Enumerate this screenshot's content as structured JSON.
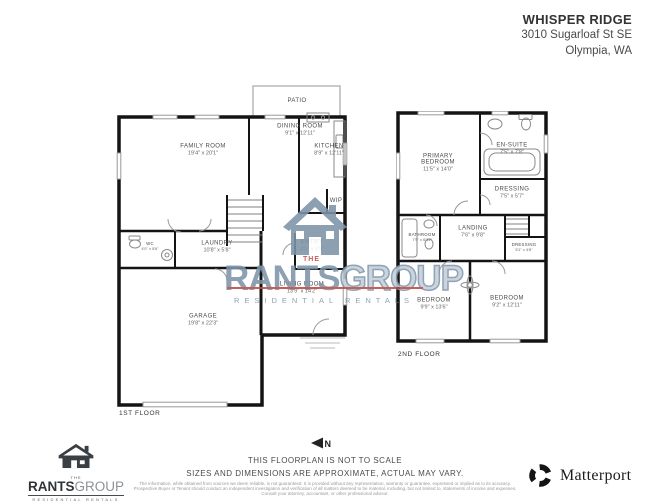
{
  "header": {
    "title": "WHISPER RIDGE",
    "address1": "3010 Sugarloaf St SE",
    "address2": "Olympia, WA"
  },
  "floor1": {
    "label": "1ST FLOOR",
    "rooms": {
      "patio": {
        "name": "PATIO",
        "dims": ""
      },
      "family": {
        "name": "FAMILY ROOM",
        "dims": "19'4\" x 20'1\""
      },
      "dining": {
        "name": "DINING ROOM",
        "dims": "9'1\" x 12'11\""
      },
      "kitchen": {
        "name": "KITCHEN",
        "dims": "8'9\" x 12'11\""
      },
      "wip": {
        "name": "WIP",
        "dims": ""
      },
      "entry": {
        "name": "ENTRY",
        "dims": "4'5\" x 9'9\""
      },
      "wc": {
        "name": "WC",
        "dims": "4'0\" x 5'6\""
      },
      "laundry": {
        "name": "LAUNDRY",
        "dims": "10'8\" x 5'8\""
      },
      "living": {
        "name": "LIVING ROOM",
        "dims": "13'9\" x 14'2\""
      },
      "garage": {
        "name": "GARAGE",
        "dims": "19'8\" x 22'3\""
      }
    }
  },
  "floor2": {
    "label": "2ND FLOOR",
    "rooms": {
      "primary": {
        "name": "PRIMARY BEDROOM",
        "dims": "11'5\" x 14'0\""
      },
      "ensuite": {
        "name": "EN-SUITE",
        "dims": "7'5\" x 7'8\""
      },
      "dressing": {
        "name": "DRESSING",
        "dims": "7'5\" x 5'7\""
      },
      "bathroom": {
        "name": "BATHROOM",
        "dims": "7'5\" x 6'11\""
      },
      "landing": {
        "name": "LANDING",
        "dims": "7'6\" x 9'8\""
      },
      "dressing2": {
        "name": "DRESSING",
        "dims": "5'1\" x 4'8\""
      },
      "bedroom1": {
        "name": "BEDROOM",
        "dims": "9'9\" x 13'6\""
      },
      "bedroom2": {
        "name": "BEDROOM",
        "dims": "9'2\" x 12'11\""
      }
    }
  },
  "watermark": {
    "the": "THE",
    "part1": "RANTS",
    "part2": "GROUP",
    "tagline": "RESIDENTIAL RENTALS",
    "slate_color": "#7e95a9",
    "red_color": "#bf4a41"
  },
  "footer": {
    "north_label": "N",
    "line1": "THIS FLOORPLAN IS NOT TO SCALE",
    "line2": "SIZES AND DIMENSIONS ARE APPROXIMATE, ACTUAL MAY VARY.",
    "disclaimer1": "The information, while obtained from sources we deem reliable, is not guaranteed. It is provided without any representation, warranty or guarantee, expressed or implied as to its accuracy.",
    "disclaimer2": "Prospective Buyer or Tenant should conduct an independent investigation and verification of all matters deemed to be material, including, but not limited to, statements of income and expenses.",
    "disclaimer3": "Consult your attorney, accountant, or other professional advisor."
  },
  "rants_logo": {
    "the": "THE",
    "part1": "RANTS",
    "part2": "GROUP",
    "tagline": "RESIDENTIAL RENTALS"
  },
  "matterport": {
    "label": "Matterport"
  },
  "colors": {
    "wall": "#141414"
  }
}
